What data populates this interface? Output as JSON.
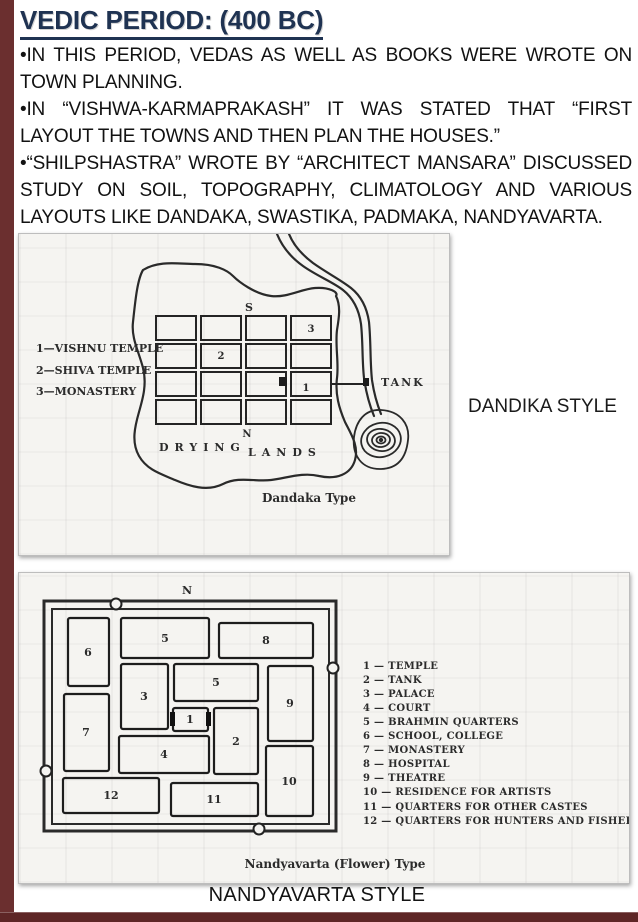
{
  "slide": {
    "title": "VEDIC PERIOD: (400 BC)",
    "title_color": "#1f3352",
    "accent_color": "#6b2f2f",
    "bullets": [
      "•IN THIS PERIOD, VEDAS AS WELL AS BOOKS WERE WROTE ON TOWN PLANNING.",
      "•IN “VISHWA-KARMAPRAKASH” IT WAS STATED THAT “FIRST LAYOUT THE TOWNS AND THEN PLAN THE HOUSES.”",
      "•“SHILPSHASTRA” WROTE BY “ARCHITECT MANSARA” DISCUSSED STUDY ON SOIL, TOPOGRAPHY, CLIMATOLOGY AND VARIOUS LAYOUTS LIKE DANDAKA, SWASTIKA, PADMAKA, NANDYAVARTA."
    ]
  },
  "dandaka_figure": {
    "style_label": "DANDIKA STYLE",
    "caption": "Dandaka Type",
    "legend": [
      "1—VISHNU TEMPLE",
      "2—SHIVA TEMPLE",
      "3—MONASTERY"
    ],
    "compass": {
      "south": "S",
      "north": "N"
    },
    "area_labels": {
      "drying": "DRYING",
      "lands": "LANDS",
      "tank": "TANK"
    },
    "cell_numbers": {
      "r1c4": "3",
      "r2c2": "2",
      "r3c4": "1"
    }
  },
  "nandyavarta_figure": {
    "style_label": "NANDYAVARTA STYLE",
    "caption": "Nandyavarta (Flower) Type",
    "north": "N",
    "blocks": [
      "6",
      "5",
      "8",
      "3",
      "5",
      "9",
      "7",
      "1",
      "2",
      "4",
      "10",
      "12",
      "11"
    ],
    "legend": [
      "1 — TEMPLE",
      "2 — TANK",
      "3 — PALACE",
      "4 — COURT",
      "5 — BRAHMIN QUARTERS",
      "6 — SCHOOL, COLLEGE",
      "7 — MONASTERY",
      "8 — HOSPITAL",
      "9 — THEATRE",
      "10 — RESIDENCE FOR ARTISTS",
      "11 — QUARTERS FOR OTHER CASTES",
      "12 — QUARTERS FOR HUNTERS AND FISHER"
    ]
  }
}
